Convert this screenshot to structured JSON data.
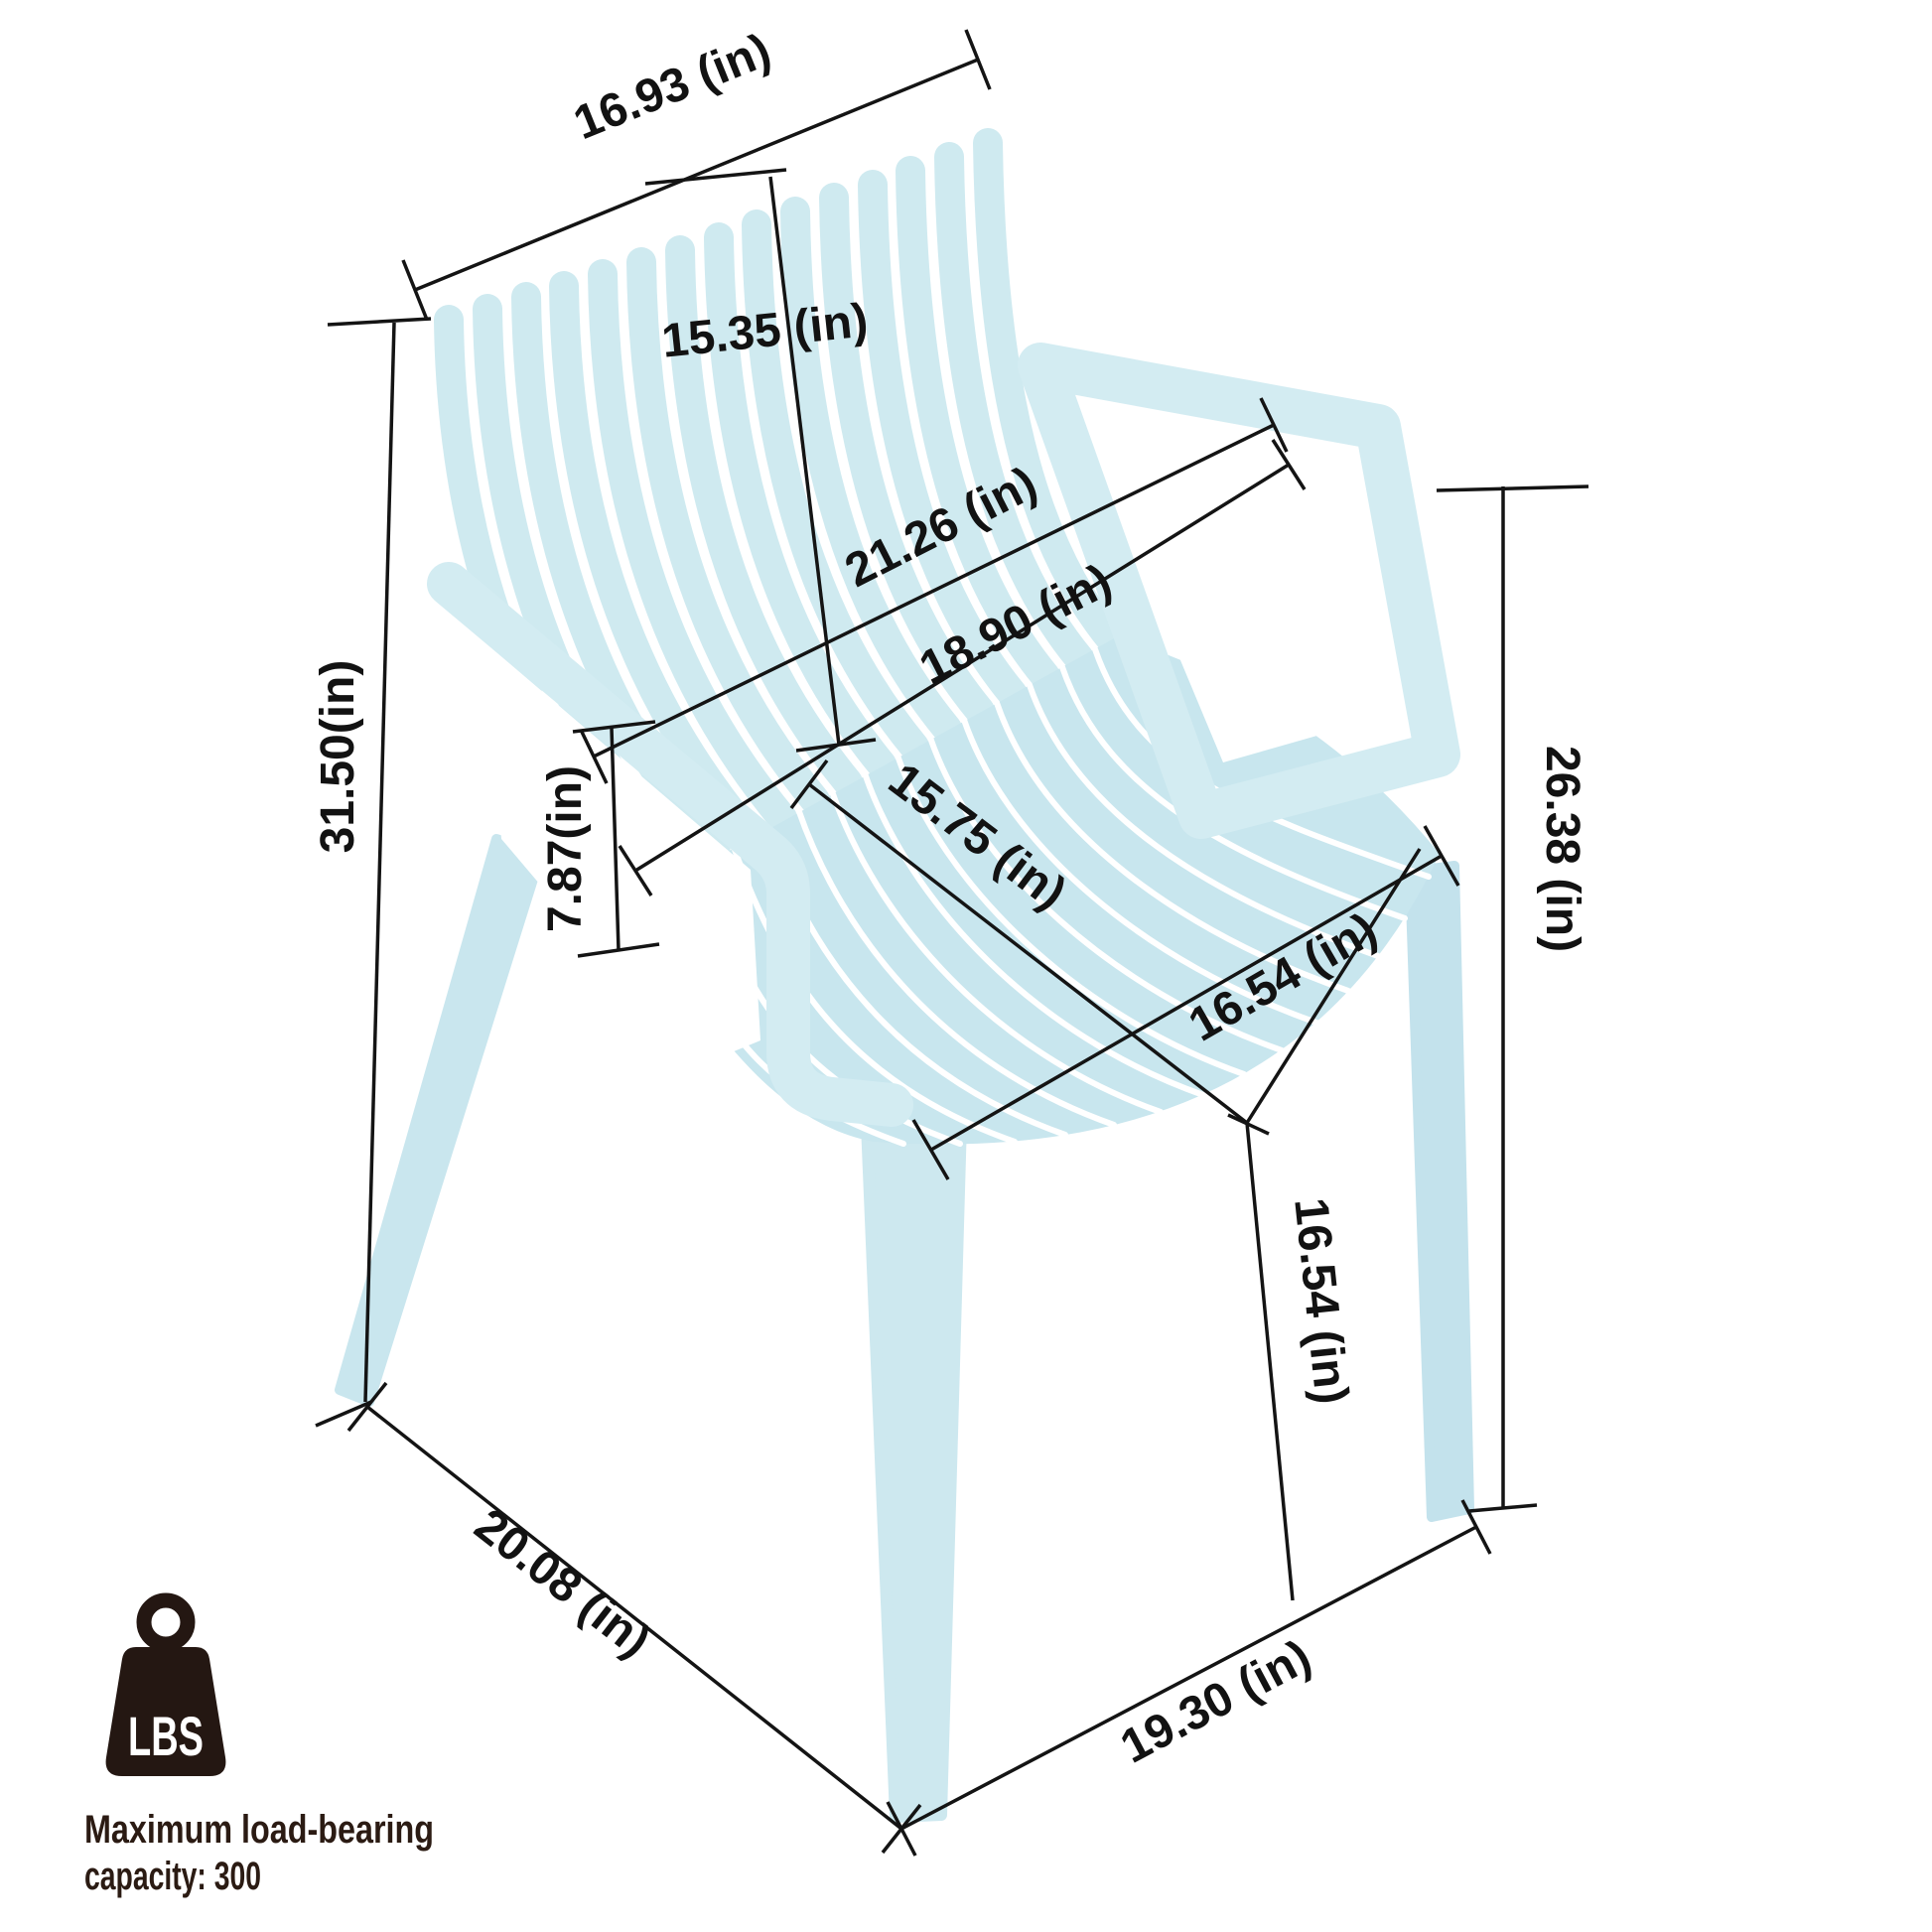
{
  "diagram_type": "product-dimension-diagram",
  "product": "slatted outdoor arm chair",
  "colors": {
    "chair_main": "#cfeaf0",
    "chair_seat": "#c8e6ee",
    "chair_legs": "#c9e6ee",
    "chair_armrest": "#d3ecf2",
    "dimension_lines": "#141414",
    "caption_text": "#2b1b13",
    "icon": "#241712",
    "background": "#ffffff"
  },
  "dimensions": {
    "back_top_width": "16.93 (in)",
    "back_height": "15.35 (in)",
    "armrest_span": "21.26 (in)",
    "back_width": "18.90 (in)",
    "overall_height": "31.50(in)",
    "armrest_to_seat": "7.87(in)",
    "seat_depth": "15.75 (in)",
    "seat_width": "16.54 (in)",
    "armrest_height": "26.38 (in)",
    "seat_height": "16.54 (in)",
    "base_depth": "20.08 (in)",
    "base_width": "19.30 (in)"
  },
  "load_capacity": {
    "icon_label": "LBS",
    "caption_line1": "Maximum load-bearing",
    "caption_line2": "capacity: 300"
  }
}
